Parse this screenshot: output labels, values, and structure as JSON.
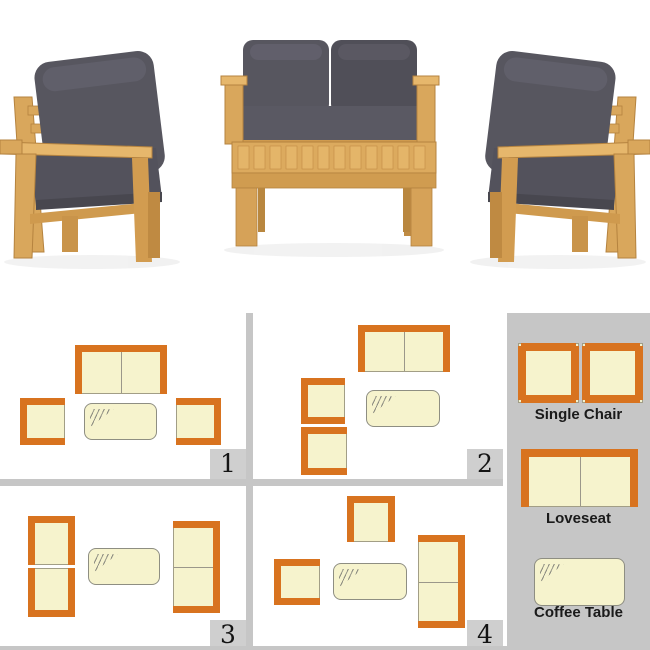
{
  "colors": {
    "accent_orange": "#d8731f",
    "cushion_cream": "#f6f3cd",
    "icon_outline": "#a29e86",
    "panel_gray": "#c6c6c6",
    "badge_gray": "#cfcfcf",
    "label_text": "#1a1a1a",
    "wood": "#d9a75c",
    "photo_cushion_gray": "#57565f"
  },
  "photo": {
    "pieces": [
      "Single Chair",
      "Loveseat",
      "Coffee Table",
      "Single Chair"
    ]
  },
  "panels": [
    {
      "number": "1",
      "items": [
        {
          "name": "loveseat-icon",
          "type": "loveseat",
          "x": 75,
          "y": 32,
          "w": 90,
          "h": 47,
          "orange": [
            "top",
            "left",
            "right"
          ],
          "divider": "v"
        },
        {
          "name": "single-chair-icon",
          "type": "chair",
          "x": 20,
          "y": 85,
          "w": 43,
          "h": 45,
          "orange": [
            "top",
            "left",
            "bottom"
          ]
        },
        {
          "name": "coffee-table-icon",
          "type": "table",
          "x": 84,
          "y": 90,
          "w": 71,
          "h": 35
        },
        {
          "name": "single-chair-icon",
          "type": "chair",
          "x": 176,
          "y": 85,
          "w": 43,
          "h": 45,
          "orange": [
            "top",
            "right",
            "bottom"
          ]
        }
      ]
    },
    {
      "number": "2",
      "items": [
        {
          "name": "loveseat-icon",
          "type": "loveseat",
          "x": 105,
          "y": 12,
          "w": 90,
          "h": 45,
          "orange": [
            "top",
            "left",
            "right"
          ],
          "divider": "v"
        },
        {
          "name": "single-chair-icon",
          "type": "chair",
          "x": 48,
          "y": 65,
          "w": 42,
          "h": 44,
          "orange": [
            "top",
            "left",
            "bottom"
          ]
        },
        {
          "name": "single-chair-icon",
          "type": "chair",
          "x": 48,
          "y": 114,
          "w": 44,
          "h": 46,
          "orange": [
            "top",
            "left",
            "bottom"
          ]
        },
        {
          "name": "coffee-table-icon",
          "type": "table",
          "x": 113,
          "y": 77,
          "w": 72,
          "h": 35
        }
      ]
    },
    {
      "number": "3",
      "items": [
        {
          "name": "single-chair-icon",
          "type": "chair",
          "x": 28,
          "y": 30,
          "w": 45,
          "h": 47,
          "orange": [
            "top",
            "left",
            "right"
          ]
        },
        {
          "name": "single-chair-icon",
          "type": "chair",
          "x": 28,
          "y": 82,
          "w": 45,
          "h": 47,
          "orange": [
            "left",
            "bottom",
            "right"
          ]
        },
        {
          "name": "coffee-table-icon",
          "type": "table",
          "x": 88,
          "y": 62,
          "w": 70,
          "h": 35
        },
        {
          "name": "loveseat-icon",
          "type": "loveseat",
          "x": 173,
          "y": 35,
          "w": 45,
          "h": 90,
          "orange": [
            "top",
            "right",
            "bottom"
          ],
          "divider": "h"
        }
      ]
    },
    {
      "number": "4",
      "items": [
        {
          "name": "single-chair-icon",
          "type": "chair",
          "x": 94,
          "y": 10,
          "w": 46,
          "h": 44,
          "orange": [
            "top",
            "left",
            "right"
          ]
        },
        {
          "name": "single-chair-icon",
          "type": "chair",
          "x": 21,
          "y": 73,
          "w": 44,
          "h": 44,
          "orange": [
            "top",
            "left",
            "bottom"
          ]
        },
        {
          "name": "coffee-table-icon",
          "type": "table",
          "x": 80,
          "y": 77,
          "w": 72,
          "h": 35
        },
        {
          "name": "loveseat-icon",
          "type": "loveseat",
          "x": 165,
          "y": 49,
          "w": 45,
          "h": 91,
          "orange": [
            "top",
            "right",
            "bottom"
          ],
          "divider": "h"
        }
      ]
    }
  ],
  "legend": {
    "entries": [
      {
        "label": "Single Chair",
        "icons": [
          {
            "name": "single-chair-icon",
            "type": "chair",
            "x": 11,
            "y": 30,
            "w": 59,
            "h": 58,
            "orange": [
              "top",
              "right",
              "bottom",
              "left"
            ],
            "bw": 8,
            "notch": 3
          },
          {
            "name": "single-chair-icon",
            "type": "chair",
            "x": 75,
            "y": 30,
            "w": 59,
            "h": 58,
            "orange": [
              "top",
              "right",
              "bottom",
              "left"
            ],
            "bw": 8,
            "notch": 3
          }
        ]
      },
      {
        "label": "Loveseat",
        "icons": [
          {
            "name": "loveseat-icon",
            "type": "loveseat",
            "x": 14,
            "y": 136,
            "w": 115,
            "h": 56,
            "orange": [
              "top",
              "left",
              "right"
            ],
            "bw": 8,
            "divider": "v"
          }
        ]
      },
      {
        "label": "Coffee Table",
        "icons": [
          {
            "name": "coffee-table-icon",
            "type": "table",
            "x": 27,
            "y": 245,
            "w": 89,
            "h": 46
          }
        ]
      }
    ]
  }
}
